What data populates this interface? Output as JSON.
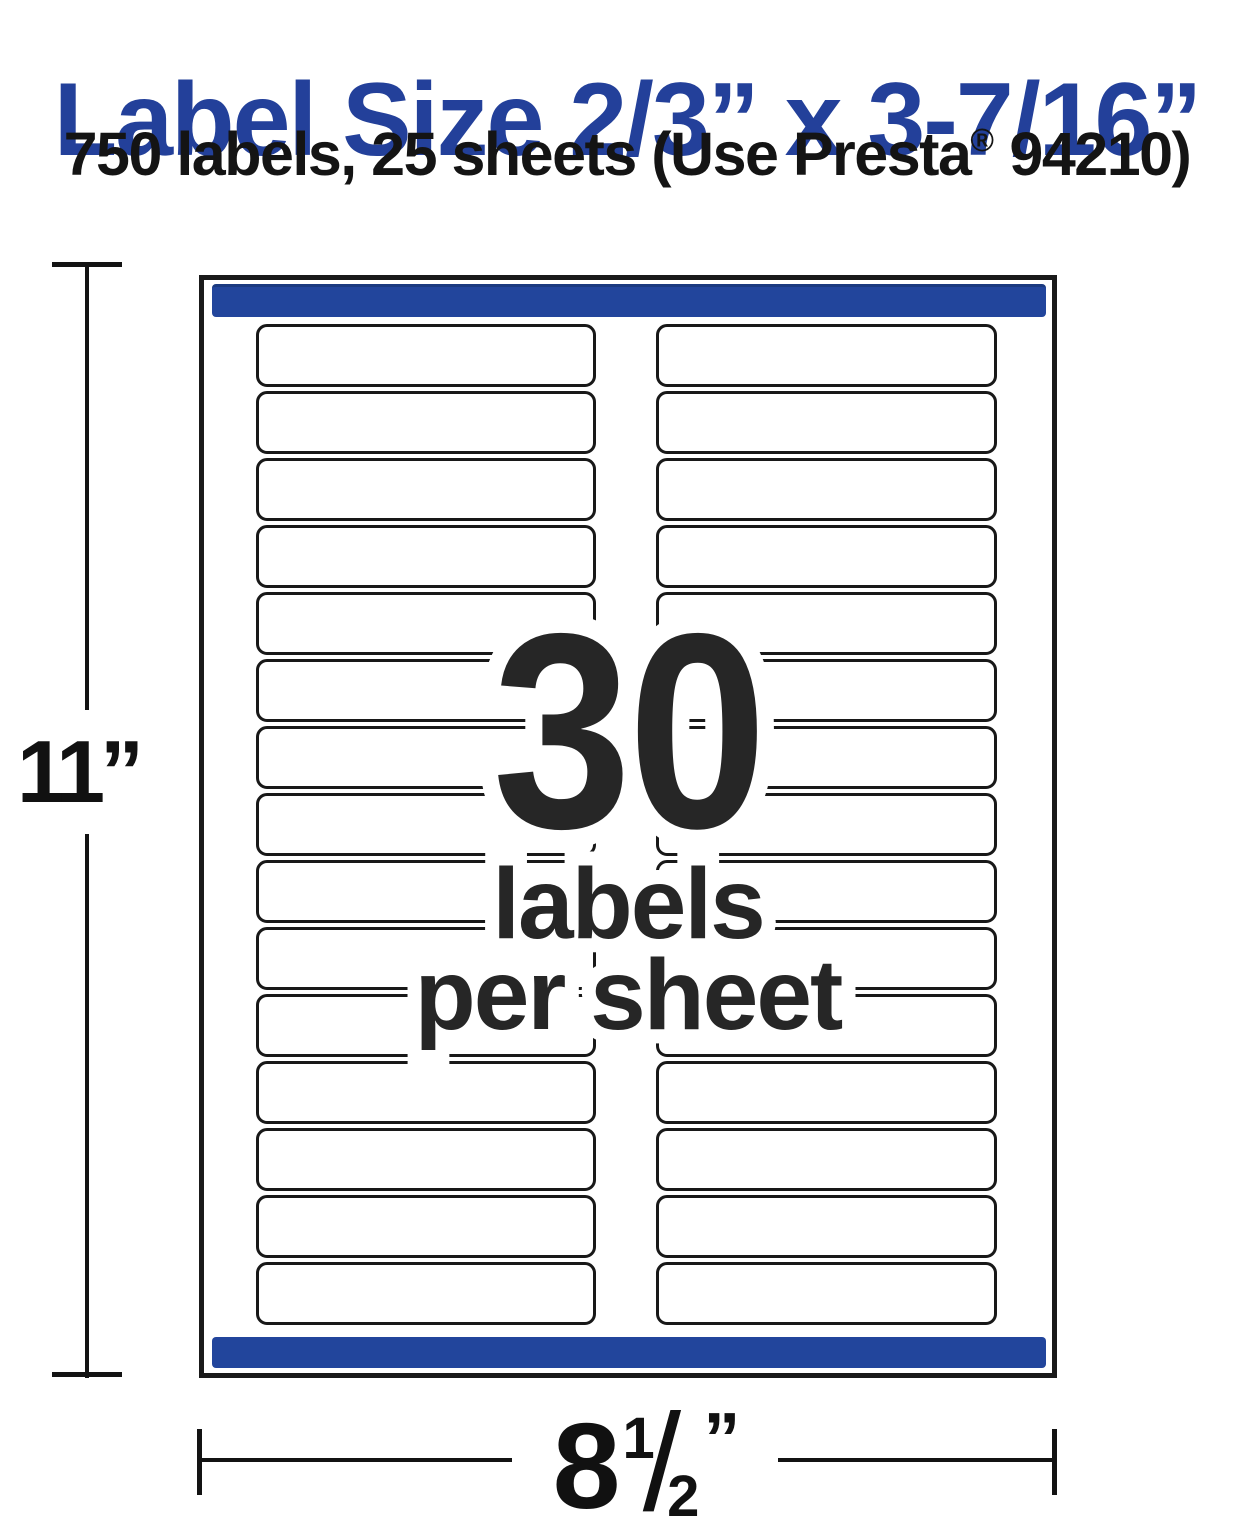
{
  "title": {
    "text": "Label Size 2/3” x 3-7/16”"
  },
  "subtitle": {
    "prefix": "750 labels, 25 sheets (Use Presta",
    "registered_mark": "®",
    "suffix": " 94210)"
  },
  "sheet": {
    "rows": 15,
    "columns": 2,
    "labels_total": 30
  },
  "overlay": {
    "count": "30",
    "line2": "labels",
    "line3": "per sheet"
  },
  "dimensions": {
    "height_value": "11",
    "height_unit": "”",
    "width_whole": "8",
    "width_numerator": "1",
    "width_fraction_slash": "/",
    "width_denominator": "2",
    "width_unit": "”"
  },
  "colors": {
    "title_blue": "#23409a",
    "bar_blue": "#22459c",
    "text_dark": "#262626",
    "line_black": "#131313"
  }
}
